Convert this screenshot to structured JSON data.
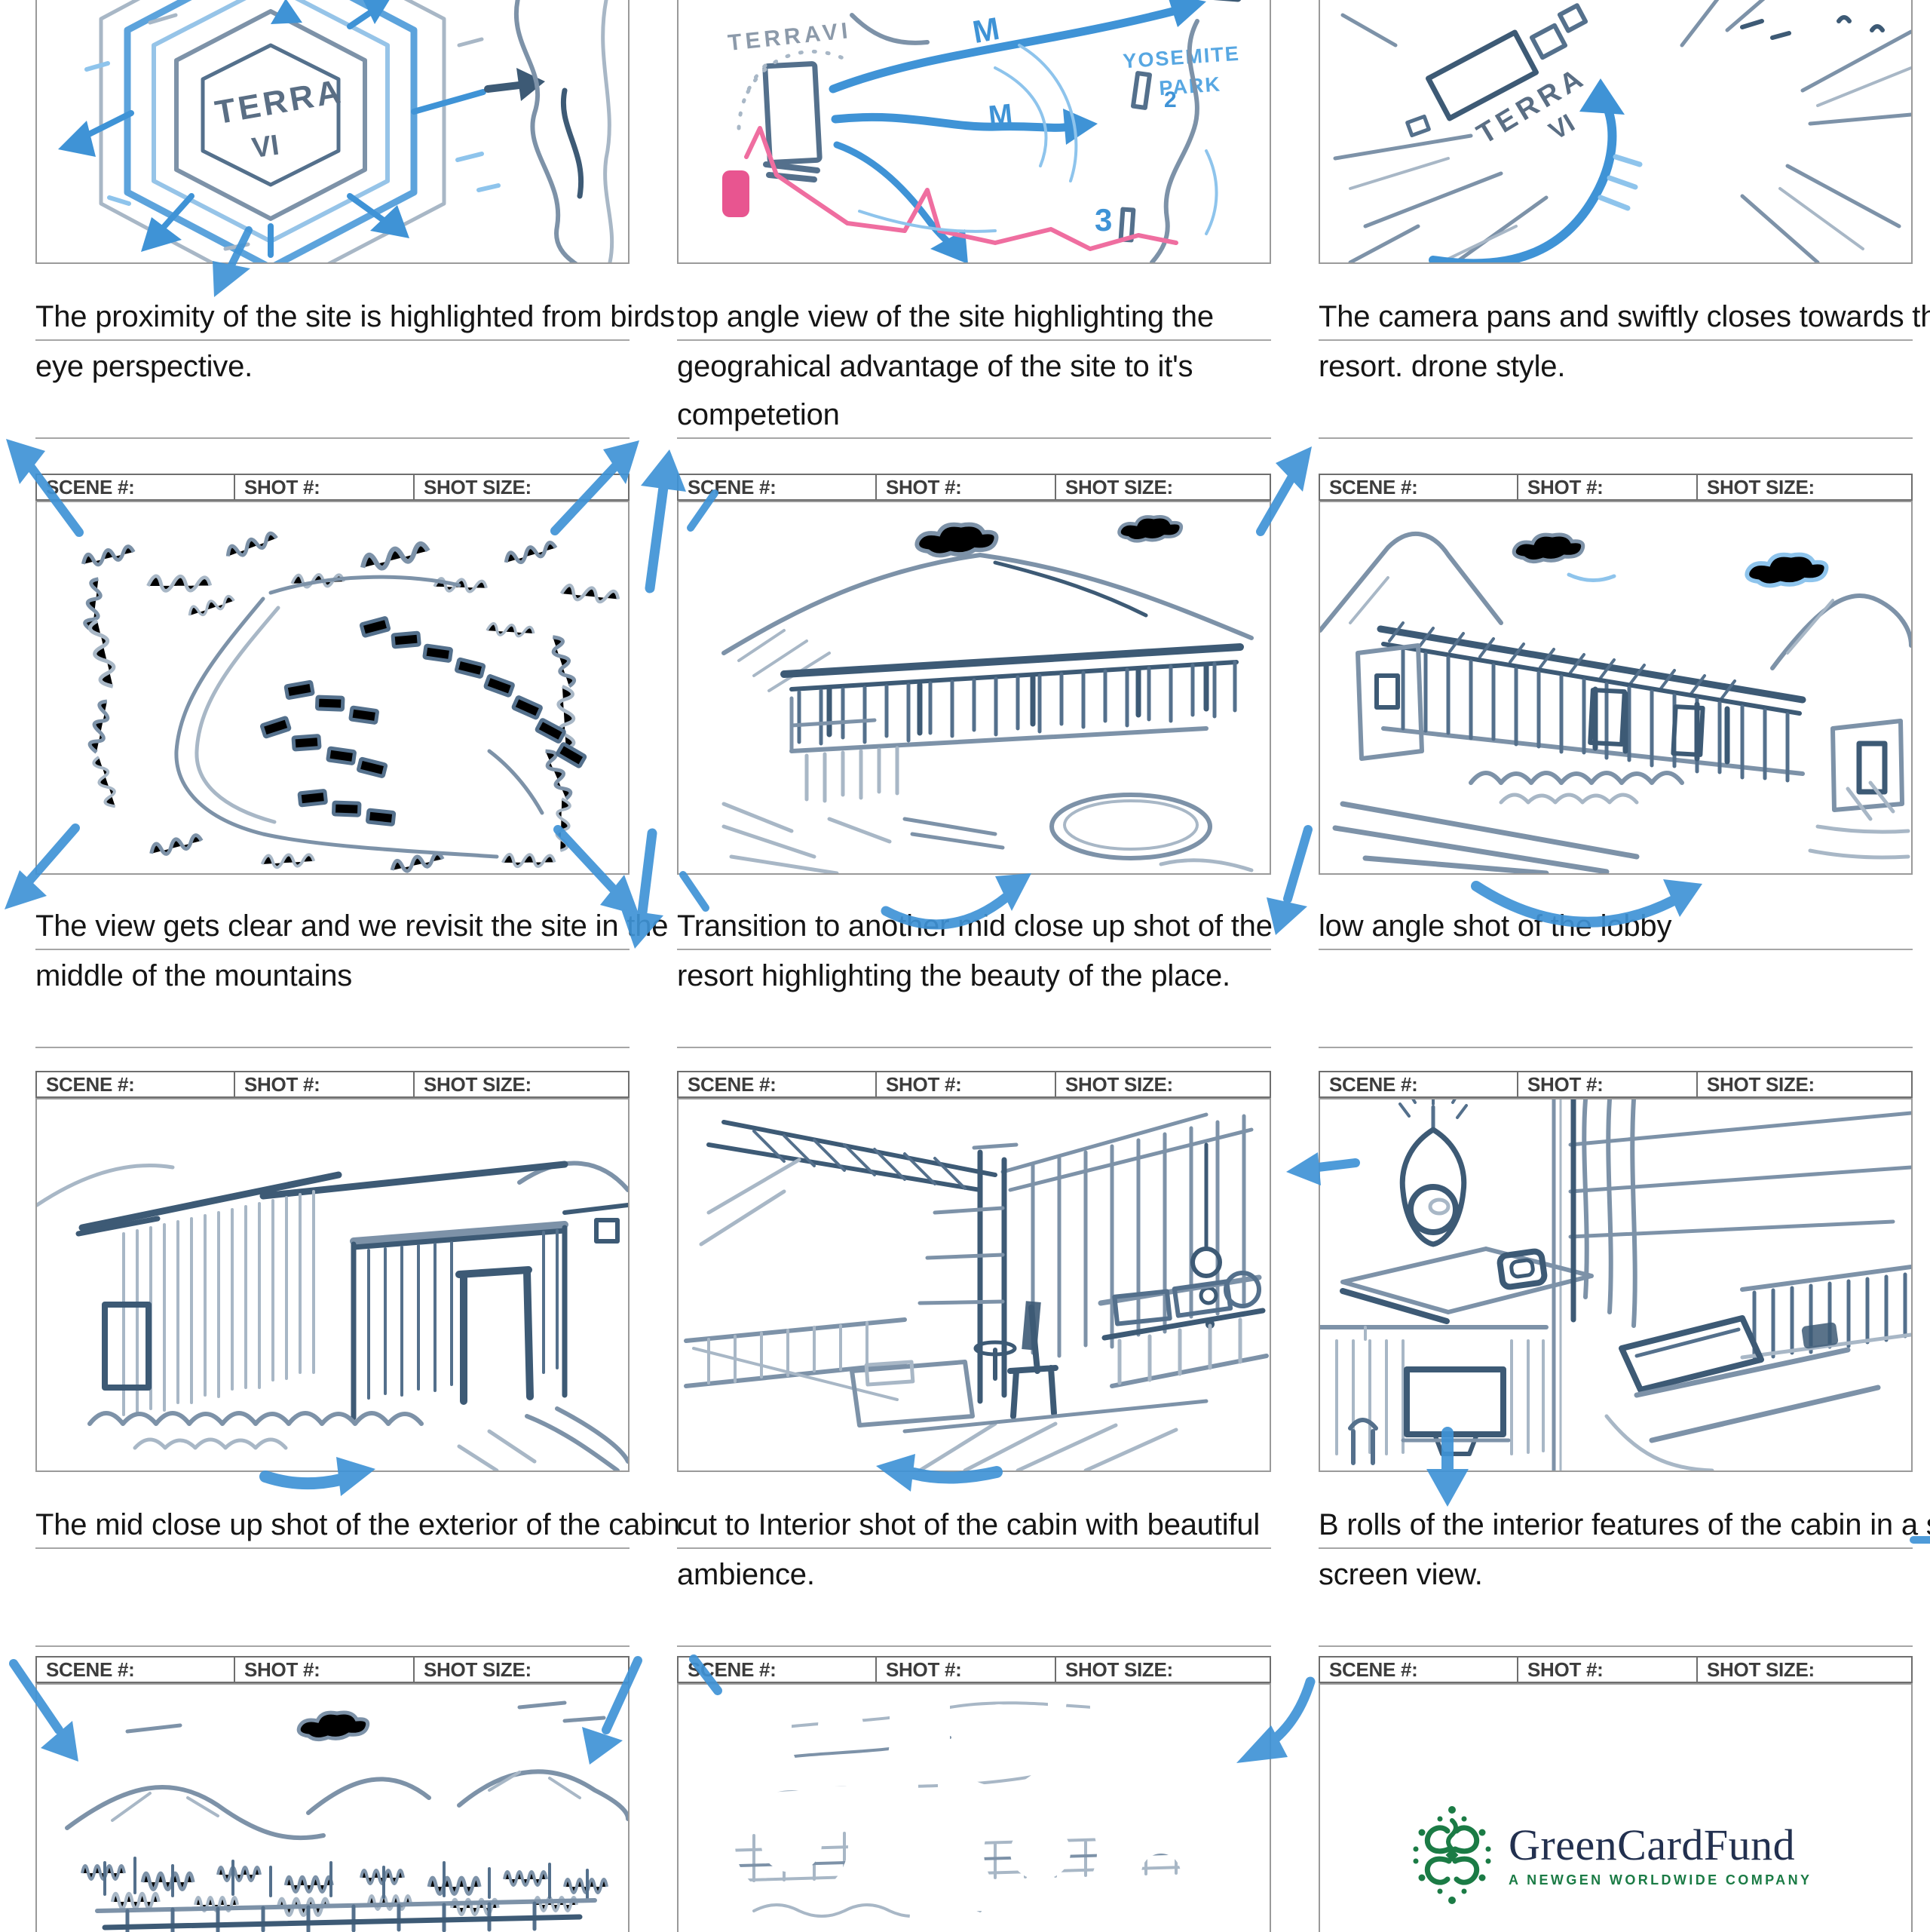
{
  "document": {
    "type": "storyboard-sheet"
  },
  "header_labels": {
    "scene": "SCENE #:",
    "shot": "SHOT #:",
    "size": "SHOT SIZE:"
  },
  "panels": [
    {
      "id": "r1c1",
      "caption_lines": [
        "The proximity of the site is highlighted from birds",
        "eye perspective."
      ]
    },
    {
      "id": "r1c2",
      "caption_lines": [
        "top angle view of the site highlighting the",
        "geograhical advantage of the site to it's",
        "competetion"
      ]
    },
    {
      "id": "r1c3",
      "caption_lines": [
        "The camera pans and swiftly closes towards the",
        "resort. drone style."
      ]
    },
    {
      "id": "r2c1",
      "caption_lines": [
        "The view gets clear and we revisit the site in the",
        "middle of the mountains"
      ]
    },
    {
      "id": "r2c2",
      "caption_lines": [
        "Transition to another mid close up shot of the",
        "resort highlighting the beauty of the place."
      ]
    },
    {
      "id": "r2c3",
      "caption_lines": [
        "low angle shot of the lobby"
      ]
    },
    {
      "id": "r3c1",
      "caption_lines": [
        "The mid close up shot of the exterior of the cabin"
      ]
    },
    {
      "id": "r3c2",
      "caption_lines": [
        "cut to Interior shot of the cabin with beautiful",
        "ambience."
      ]
    },
    {
      "id": "r3c3",
      "caption_lines": [
        "B rolls of the interior features of the cabin in a split",
        "screen view."
      ]
    },
    {
      "id": "r4c1"
    },
    {
      "id": "r4c2"
    },
    {
      "id": "r4c3"
    }
  ],
  "sketch_labels": {
    "terra_line1": "TERRA",
    "terra_line2": "VI",
    "terra_map": "TERRAVI",
    "terra_persp_1": "TERRA",
    "terra_persp_2": "VI",
    "yosemite_line1": "YOSEMITE",
    "yosemite_line2": "PARK",
    "route_m1": "M",
    "route_m2": "M",
    "route_3": "3",
    "route_2": "2"
  },
  "logo": {
    "name": "GreenCardFund",
    "tagline": "A NEWGEN WORLDWIDE COMPANY"
  },
  "colors": {
    "marker_blue": "#3F93D6",
    "sketch_light": "#A8B7C6",
    "sketch_mid": "#7D92A8",
    "sketch_dark": "#54708C",
    "pink": "#E85590",
    "panel_dark": "#67686A",
    "logo_green": "#1B7B45",
    "logo_navy": "#22304F"
  }
}
